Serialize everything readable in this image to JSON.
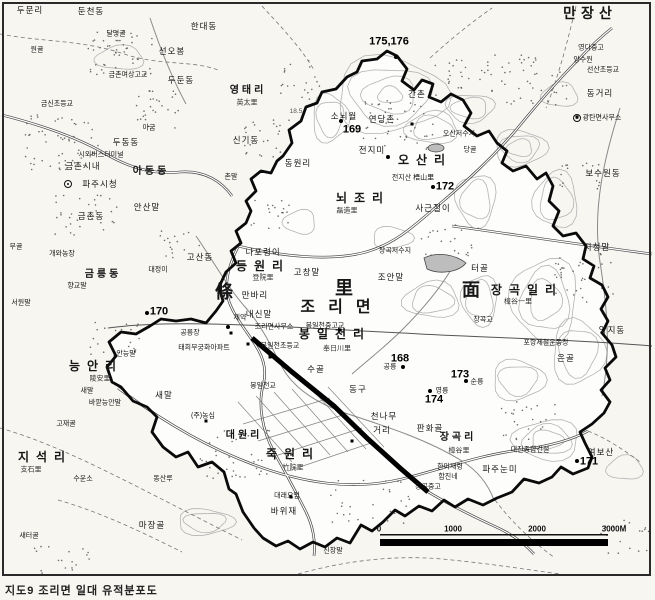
{
  "map": {
    "caption": "지도9  조리면 일대 유적분포도",
    "scale_bar": {
      "ticks": [
        {
          "t": "0",
          "x": 379
        },
        {
          "t": "1000",
          "x": 453
        },
        {
          "t": "2000",
          "x": 537
        },
        {
          "t": "3000M",
          "x": 614
        }
      ]
    },
    "sites": [
      {
        "n": "175,176",
        "x": 389,
        "y": 42
      },
      {
        "n": "169",
        "x": 352,
        "y": 130
      },
      {
        "n": "170",
        "x": 159,
        "y": 312
      },
      {
        "n": "171",
        "x": 589,
        "y": 462
      },
      {
        "n": "172",
        "x": 445,
        "y": 187
      },
      {
        "n": "173",
        "x": 460,
        "y": 375
      },
      {
        "n": "174",
        "x": 434,
        "y": 400
      },
      {
        "n": "168",
        "x": 400,
        "y": 359
      }
    ],
    "markers": [
      [
        396,
        57
      ],
      [
        341,
        121
      ],
      [
        388,
        157
      ],
      [
        433,
        187
      ],
      [
        147,
        313
      ],
      [
        228,
        327
      ],
      [
        403,
        367
      ],
      [
        466,
        381
      ],
      [
        430,
        391
      ],
      [
        577,
        461
      ]
    ],
    "buildings": [
      [
        248,
        344
      ],
      [
        270,
        357
      ],
      [
        206,
        421
      ],
      [
        291,
        497
      ],
      [
        352,
        441
      ],
      [
        577,
        117
      ],
      [
        412,
        124
      ],
      [
        340,
        330
      ],
      [
        231,
        333
      ]
    ],
    "gov_symbols": [
      [
        68,
        184
      ],
      [
        577,
        118
      ]
    ],
    "labels": [
      {
        "t": "두문리",
        "x": 30,
        "y": 10,
        "c": "sm"
      },
      {
        "t": "둔천동",
        "x": 91,
        "y": 11,
        "c": "sm"
      },
      {
        "t": "달명골",
        "x": 116,
        "y": 34,
        "c": "xs"
      },
      {
        "t": "한대동",
        "x": 204,
        "y": 26,
        "c": "sm"
      },
      {
        "t": "원골",
        "x": 37,
        "y": 50,
        "c": "xs"
      },
      {
        "t": "선오봉",
        "x": 172,
        "y": 51,
        "c": "sm"
      },
      {
        "t": "금촌여상고교",
        "x": 128,
        "y": 75,
        "c": "xs"
      },
      {
        "t": "두둔동",
        "x": 181,
        "y": 80,
        "c": "sm"
      },
      {
        "t": "금신초등교",
        "x": 57,
        "y": 104,
        "c": "xs"
      },
      {
        "t": "아금",
        "x": 149,
        "y": 128,
        "c": "xs"
      },
      {
        "t": "두동동",
        "x": 126,
        "y": 142,
        "c": "sm"
      },
      {
        "t": "시외버스터미널",
        "x": 101,
        "y": 155,
        "c": "xs"
      },
      {
        "t": "금촌시내",
        "x": 83,
        "y": 166,
        "c": "sm"
      },
      {
        "t": "아동동",
        "x": 151,
        "y": 172,
        "c": "md"
      },
      {
        "t": "파주시청",
        "x": 100,
        "y": 184,
        "c": "sm"
      },
      {
        "t": "영태리",
        "x": 248,
        "y": 91,
        "c": "md"
      },
      {
        "t": "英太里",
        "x": 247,
        "y": 103,
        "c": "hj"
      },
      {
        "t": "신기동",
        "x": 246,
        "y": 140,
        "c": "sm"
      },
      {
        "t": "촌말",
        "x": 231,
        "y": 177,
        "c": "xs"
      },
      {
        "t": "만장산",
        "x": 590,
        "y": 13,
        "c": "peak"
      },
      {
        "t": "영다중고",
        "x": 591,
        "y": 48,
        "c": "xs"
      },
      {
        "t": "양수원",
        "x": 583,
        "y": 60,
        "c": "xs"
      },
      {
        "t": "선산초등교",
        "x": 603,
        "y": 70,
        "c": "xs"
      },
      {
        "t": "동거리",
        "x": 600,
        "y": 93,
        "c": "sm"
      },
      {
        "t": "광탄면사무소",
        "x": 602,
        "y": 118,
        "c": "xs"
      },
      {
        "t": "보수원동",
        "x": 603,
        "y": 173,
        "c": "sm"
      },
      {
        "t": "지청말",
        "x": 597,
        "y": 247,
        "c": "sm"
      },
      {
        "t": "양지동",
        "x": 612,
        "y": 330,
        "c": "sm"
      },
      {
        "t": "무골",
        "x": 16,
        "y": 247,
        "c": "xs"
      },
      {
        "t": "금촌동",
        "x": 91,
        "y": 216,
        "c": "sm"
      },
      {
        "t": "안산말",
        "x": 147,
        "y": 207,
        "c": "sm"
      },
      {
        "t": "개와농장",
        "x": 62,
        "y": 254,
        "c": "xs"
      },
      {
        "t": "금릉동",
        "x": 103,
        "y": 275,
        "c": "md"
      },
      {
        "t": "대정이",
        "x": 158,
        "y": 270,
        "c": "xs"
      },
      {
        "t": "향교말",
        "x": 77,
        "y": 286,
        "c": "xs"
      },
      {
        "t": "서원말",
        "x": 21,
        "y": 303,
        "c": "xs"
      },
      {
        "t": "고산동",
        "x": 200,
        "y": 257,
        "c": "sm"
      },
      {
        "t": "지석리",
        "x": 45,
        "y": 457,
        "c": "lg"
      },
      {
        "t": "支石里",
        "x": 31,
        "y": 470,
        "c": "hj"
      },
      {
        "t": "고재골",
        "x": 66,
        "y": 424,
        "c": "xs"
      },
      {
        "t": "수운소",
        "x": 83,
        "y": 479,
        "c": "xs"
      },
      {
        "t": "동산루",
        "x": 163,
        "y": 479,
        "c": "xs"
      },
      {
        "t": "마장골",
        "x": 152,
        "y": 525,
        "c": "sm"
      },
      {
        "t": "새터골",
        "x": 29,
        "y": 536,
        "c": "xs"
      },
      {
        "t": "신창말",
        "x": 333,
        "y": 551,
        "c": "xs"
      },
      {
        "t": "동원리",
        "x": 298,
        "y": 163,
        "c": "sm"
      },
      {
        "t": "소뇌월",
        "x": 344,
        "y": 116,
        "c": "sm"
      },
      {
        "t": "연당촌",
        "x": 382,
        "y": 119,
        "c": "sm"
      },
      {
        "t": "간촌",
        "x": 417,
        "y": 94,
        "c": "sm"
      },
      {
        "t": "전지미",
        "x": 372,
        "y": 150,
        "c": "sm"
      },
      {
        "t": "오산리",
        "x": 425,
        "y": 160,
        "c": "lg"
      },
      {
        "t": "전지산 梧山里",
        "x": 413,
        "y": 178,
        "c": "xs"
      },
      {
        "t": "뇌조리",
        "x": 363,
        "y": 198,
        "c": "lg"
      },
      {
        "t": "磊造里",
        "x": 347,
        "y": 211,
        "c": "hj"
      },
      {
        "t": "오산저수지",
        "x": 459,
        "y": 134,
        "c": "xs"
      },
      {
        "t": "당골",
        "x": 470,
        "y": 150,
        "c": "xs"
      },
      {
        "t": "사근절이",
        "x": 433,
        "y": 208,
        "c": "sm"
      },
      {
        "t": "18.5",
        "x": 296,
        "y": 112,
        "c": "xs2"
      },
      {
        "t": "나포령이",
        "x": 263,
        "y": 252,
        "c": "sm"
      },
      {
        "t": "등원리",
        "x": 263,
        "y": 266,
        "c": "lg"
      },
      {
        "t": "登院里",
        "x": 263,
        "y": 278,
        "c": "hj"
      },
      {
        "t": "고창말",
        "x": 307,
        "y": 272,
        "c": "sm"
      },
      {
        "t": "조안말",
        "x": 391,
        "y": 277,
        "c": "sm"
      },
      {
        "t": "장곡저수지",
        "x": 395,
        "y": 251,
        "c": "xs"
      },
      {
        "t": "만바리",
        "x": 255,
        "y": 295,
        "c": "sm"
      },
      {
        "t": "내신말",
        "x": 259,
        "y": 314,
        "c": "sm"
      },
      {
        "t": "조리면사무소",
        "x": 274,
        "y": 327,
        "c": "xs"
      },
      {
        "t": "봉일천중고교",
        "x": 325,
        "y": 326,
        "c": "xs"
      },
      {
        "t": "조리면",
        "x": 342,
        "y": 308,
        "c": "xl"
      },
      {
        "t": "條",
        "x": 224,
        "y": 292,
        "c": "seal"
      },
      {
        "t": "里",
        "x": 344,
        "y": 288,
        "c": "seal"
      },
      {
        "t": "面",
        "x": 471,
        "y": 290,
        "c": "seal"
      },
      {
        "t": "장곡일리",
        "x": 527,
        "y": 290,
        "c": "lg"
      },
      {
        "t": "樟谷一里",
        "x": 518,
        "y": 302,
        "c": "hj"
      },
      {
        "t": "터골",
        "x": 480,
        "y": 268,
        "c": "sm"
      },
      {
        "t": "장곡교",
        "x": 483,
        "y": 320,
        "c": "xs"
      },
      {
        "t": "포항제철운동장",
        "x": 546,
        "y": 343,
        "c": "xs"
      },
      {
        "t": "은골",
        "x": 566,
        "y": 358,
        "c": "sm"
      },
      {
        "t": "봉일천리",
        "x": 335,
        "y": 334,
        "c": "lg"
      },
      {
        "t": "奉日川里",
        "x": 337,
        "y": 349,
        "c": "hj"
      },
      {
        "t": "봉일천초등교",
        "x": 280,
        "y": 346,
        "c": "xs"
      },
      {
        "t": "수골",
        "x": 316,
        "y": 369,
        "c": "sm"
      },
      {
        "t": "동구",
        "x": 358,
        "y": 389,
        "c": "sm"
      },
      {
        "t": "공릉",
        "x": 390,
        "y": 367,
        "c": "xs"
      },
      {
        "t": "순릉",
        "x": 477,
        "y": 382,
        "c": "xs"
      },
      {
        "t": "영릉",
        "x": 442,
        "y": 391,
        "c": "xs"
      },
      {
        "t": "안능말",
        "x": 126,
        "y": 354,
        "c": "xs"
      },
      {
        "t": "능안리",
        "x": 96,
        "y": 366,
        "c": "lg"
      },
      {
        "t": "陵安里",
        "x": 100,
        "y": 379,
        "c": "hj"
      },
      {
        "t": "태희무궁화아파트",
        "x": 204,
        "y": 348,
        "c": "xs"
      },
      {
        "t": "공릉장",
        "x": 190,
        "y": 333,
        "c": "xs"
      },
      {
        "t": "제약",
        "x": 240,
        "y": 318,
        "c": "xs"
      },
      {
        "t": "새말",
        "x": 87,
        "y": 391,
        "c": "xs"
      },
      {
        "t": "바깥능안말",
        "x": 105,
        "y": 403,
        "c": "xs"
      },
      {
        "t": "새말",
        "x": 164,
        "y": 395,
        "c": "sm"
      },
      {
        "t": "봉일천교",
        "x": 263,
        "y": 386,
        "c": "xs"
      },
      {
        "t": "(주)농심",
        "x": 203,
        "y": 416,
        "c": "xs"
      },
      {
        "t": "대원리",
        "x": 244,
        "y": 436,
        "c": "md"
      },
      {
        "t": "죽원리",
        "x": 293,
        "y": 454,
        "c": "lg"
      },
      {
        "t": "竹院里",
        "x": 293,
        "y": 468,
        "c": "hj"
      },
      {
        "t": "대래요업",
        "x": 287,
        "y": 496,
        "c": "xs"
      },
      {
        "t": "바위재",
        "x": 284,
        "y": 511,
        "c": "sm"
      },
      {
        "t": "천나무",
        "x": 384,
        "y": 416,
        "c": "sm"
      },
      {
        "t": "거리",
        "x": 382,
        "y": 430,
        "c": "sm"
      },
      {
        "t": "판화골",
        "x": 430,
        "y": 428,
        "c": "sm"
      },
      {
        "t": "장곡리",
        "x": 458,
        "y": 438,
        "c": "md"
      },
      {
        "t": "樟谷里",
        "x": 459,
        "y": 451,
        "c": "hj"
      },
      {
        "t": "한미재령",
        "x": 450,
        "y": 467,
        "c": "xs"
      },
      {
        "t": "함진네",
        "x": 448,
        "y": 477,
        "c": "xs"
      },
      {
        "t": "파주눈미",
        "x": 500,
        "y": 469,
        "c": "sm"
      },
      {
        "t": "대진종합건설",
        "x": 530,
        "y": 450,
        "c": "xs"
      },
      {
        "t": "장곡중고",
        "x": 428,
        "y": 487,
        "c": "xs"
      },
      {
        "t": "여보산",
        "x": 601,
        "y": 452,
        "c": "sm"
      }
    ]
  }
}
